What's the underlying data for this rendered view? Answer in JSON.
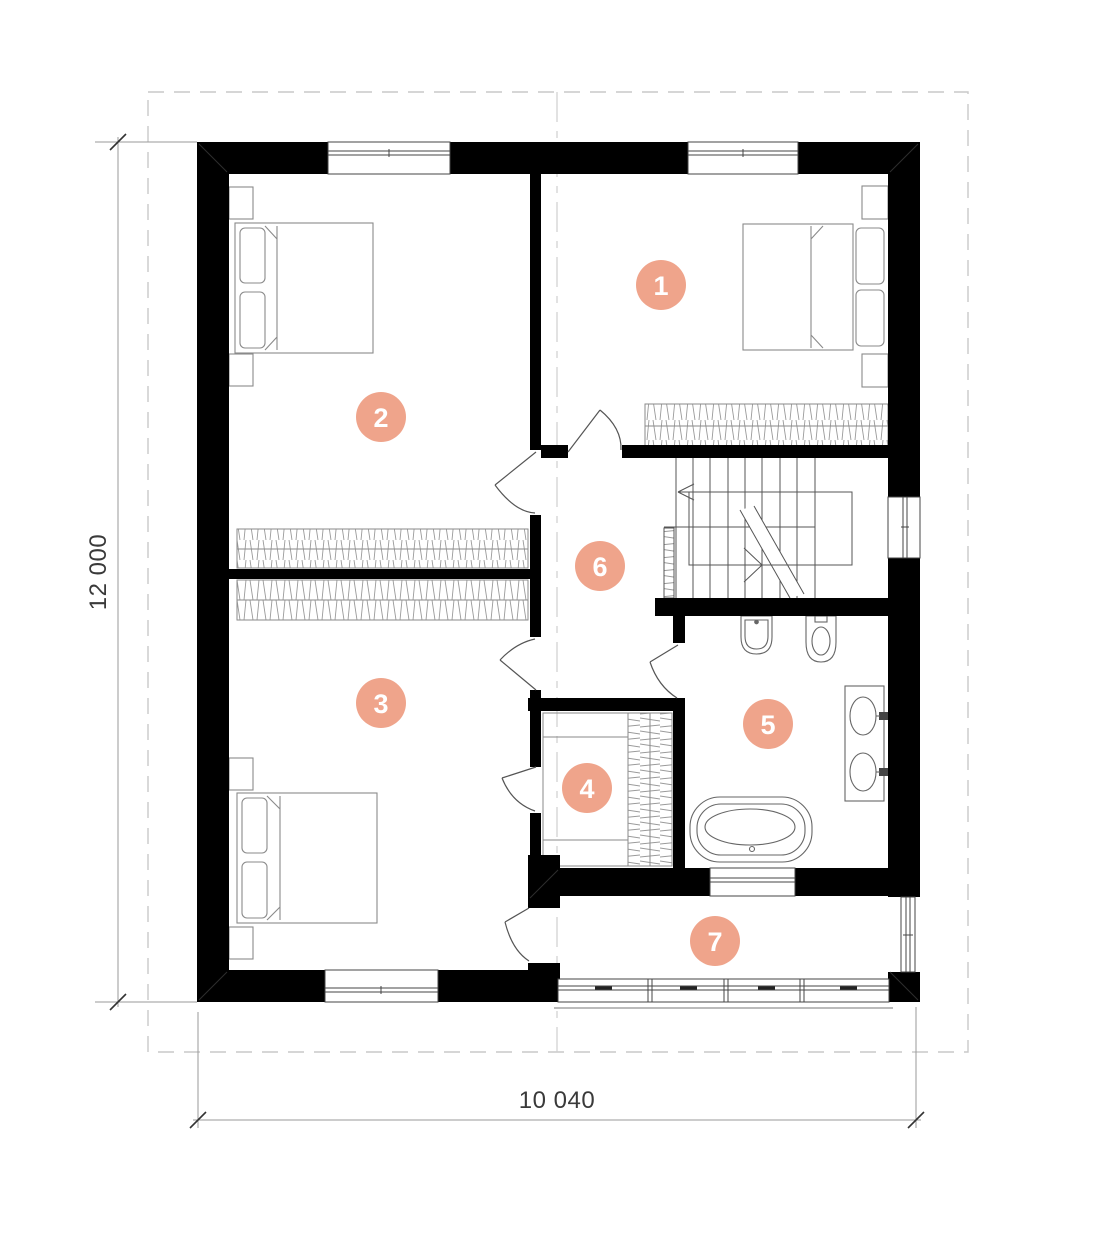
{
  "plan": {
    "title": "second-floor-plan",
    "dimension_labels": {
      "vertical": "12 000",
      "horizontal": "10 040"
    },
    "rooms": [
      {
        "number": "1"
      },
      {
        "number": "2"
      },
      {
        "number": "3"
      },
      {
        "number": "4"
      },
      {
        "number": "5"
      },
      {
        "number": "6"
      },
      {
        "number": "7"
      }
    ],
    "colors": {
      "badge_fill": "#efa48b",
      "badge_text": "#ffffff",
      "wall": "#000000",
      "dim_text": "#3a3a3a",
      "furniture_line": "#8a8a8a",
      "boundary_dash": "#c9c9c9"
    }
  }
}
